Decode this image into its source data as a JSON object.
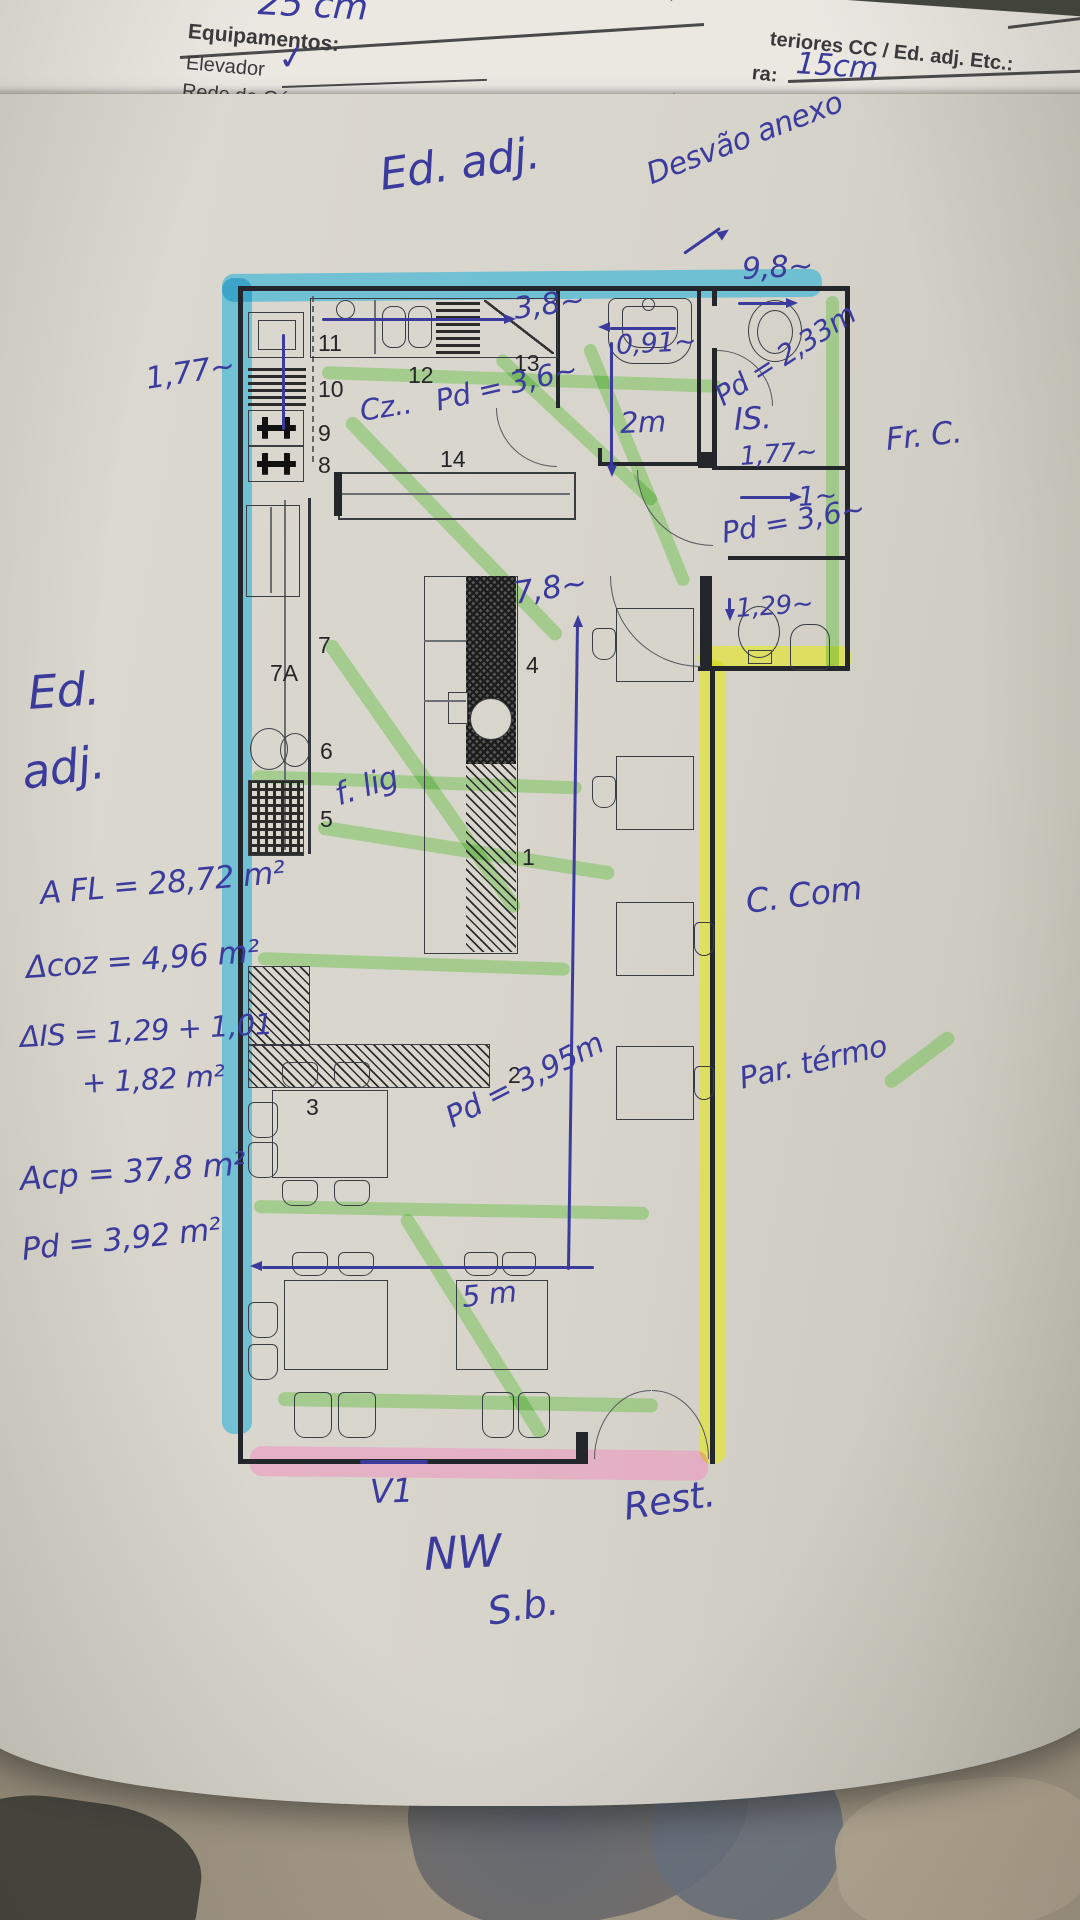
{
  "colors": {
    "pen_blue": "#3b3b9e",
    "print_black": "#26262a",
    "hl_cyan": "#2fb3d6",
    "hl_green": "#6fc24d",
    "hl_yellow": "#e4e72c",
    "hl_pink": "#f093bf",
    "paper": "#d7d4cc"
  },
  "header": {
    "top_fragment": "25 cm",
    "left": {
      "title": "Equipamentos:",
      "item1": "Elevador",
      "check": "✓",
      "item2": "Rede de Gá"
    },
    "right": {
      "line1": "teriores CC / Ed. adj. Etc.:",
      "label2": "ra:",
      "value2": "15cm"
    }
  },
  "plan": {
    "numbers": {
      "n1": "1",
      "n2": "2",
      "n3": "3",
      "n4": "4",
      "n5": "5",
      "n6": "6",
      "n7": "7",
      "n7a": "7A",
      "n8": "8",
      "n9": "9",
      "n10": "10",
      "n11": "11",
      "n12": "12",
      "n13": "13",
      "n14": "14"
    }
  },
  "annotations": {
    "ed_adj_top": "Ed. adj.",
    "desvao_anexo": "Desvão anexo",
    "dim_9_8": "9,8~",
    "dim_3_8": "3,8~",
    "dim_0_91": "0,91~",
    "pd_2_33": "Pd = 2,33m",
    "dim_1_77_margin": "1,77~",
    "cz": "Cz..",
    "pd_3_6_kitchen": "Pd = 3,6~",
    "dim_2m": "2m",
    "is_label": "IS.",
    "dim_1_77_is": "1,77~",
    "dim_1": "1~",
    "pd_3_6_is": "Pd = 3,6~",
    "dim_1_29": "1,29~",
    "fr_c": "Fr. C.",
    "ed_left_1": "Ed.",
    "ed_left_2": "adj.",
    "dim_7_8": "7,8~",
    "f_lig": "f. lig",
    "area_fl": "A FL = 28,72 m²",
    "area_coz": "Δcoz = 4,96 m²",
    "area_is_a": "ΔIS = 1,29 + 1,01",
    "area_is_b": "+ 1,82 m²",
    "area_cp": "Acp = 37,8 m²",
    "pd_total": "Pd = 3,92 m²",
    "c_com": "C. Com",
    "par_termo": "Par. térmo",
    "pd_3_95": "Pd = 3,95m",
    "dim_5m": "5 m",
    "v1": "V1",
    "rest": "Rest.",
    "nw": "NW",
    "sb": "S.b."
  }
}
